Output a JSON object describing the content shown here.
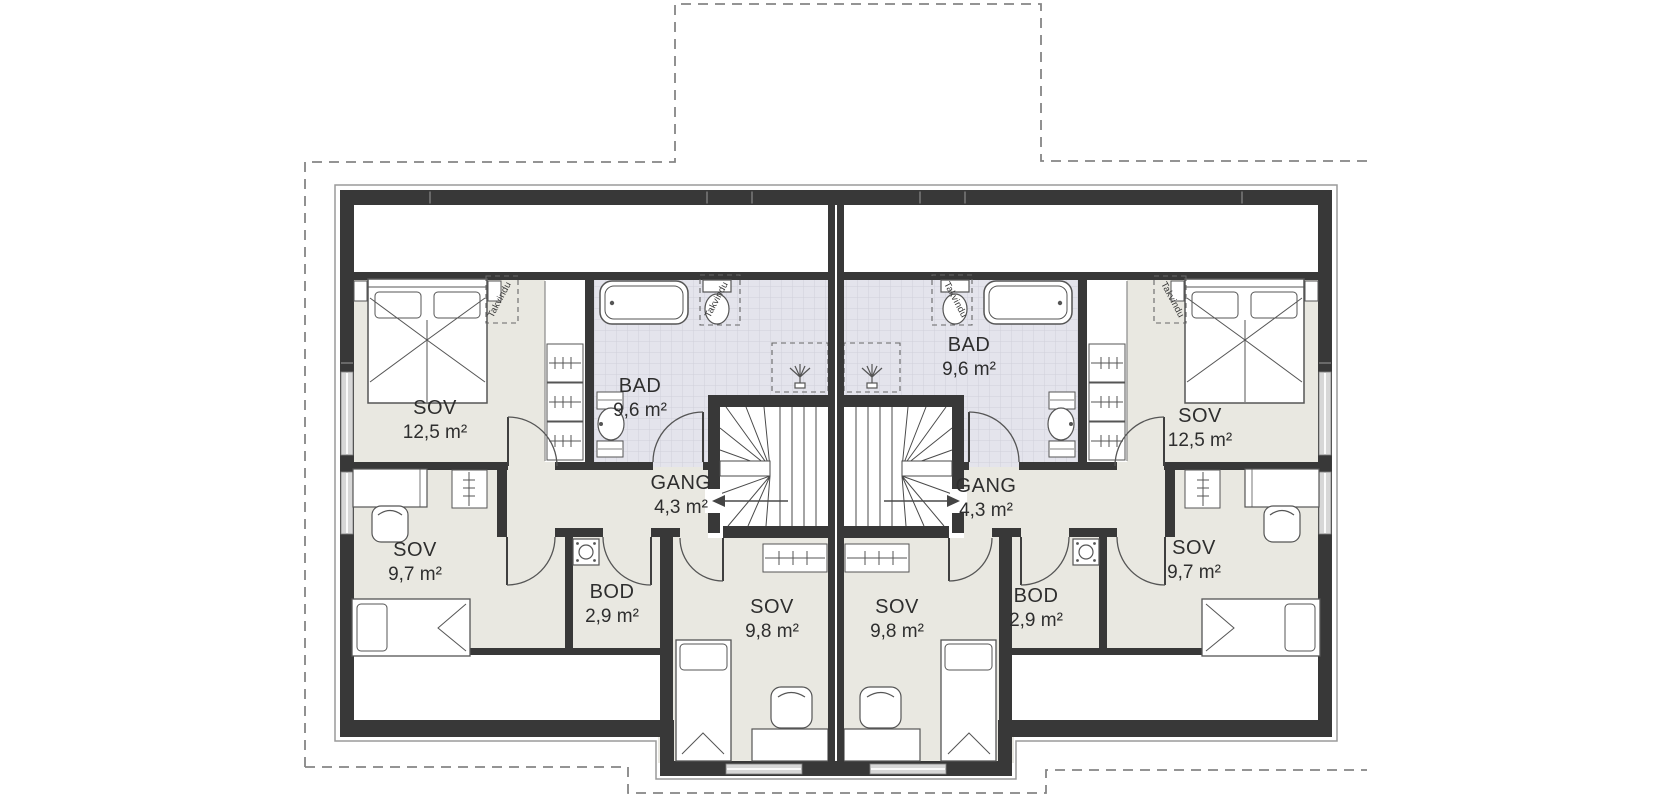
{
  "plan": {
    "type": "floor-plan",
    "colors": {
      "wall": "#383838",
      "room_fill": "#e9e8e1",
      "bath_fill": "#e4e4ec",
      "bath_grid": "#d0d0da",
      "outline_dash": "#858585",
      "fixture_stroke": "#555555"
    },
    "units": [
      {
        "side": "left",
        "rooms": [
          {
            "name": "SOV",
            "area": "12,5 m²"
          },
          {
            "name": "BAD",
            "area": "9,6 m²"
          },
          {
            "name": "GANG",
            "area": "4,3 m²"
          },
          {
            "name": "SOV",
            "area": "9,7 m²"
          },
          {
            "name": "BOD",
            "area": "2,9 m²"
          },
          {
            "name": "SOV",
            "area": "9,8 m²"
          }
        ]
      },
      {
        "side": "right",
        "rooms": [
          {
            "name": "SOV",
            "area": "12,5 m²"
          },
          {
            "name": "BAD",
            "area": "9,6 m²"
          },
          {
            "name": "GANG",
            "area": "4,3 m²"
          },
          {
            "name": "SOV",
            "area": "9,7 m²"
          },
          {
            "name": "BOD",
            "area": "2,9 m²"
          },
          {
            "name": "SOV",
            "area": "9,8 m²"
          }
        ]
      }
    ],
    "skylights": [
      {
        "label": "Takvindu"
      },
      {
        "label": "Takvindu"
      },
      {
        "label": "Takvindu"
      },
      {
        "label": "Takvindu"
      }
    ]
  }
}
